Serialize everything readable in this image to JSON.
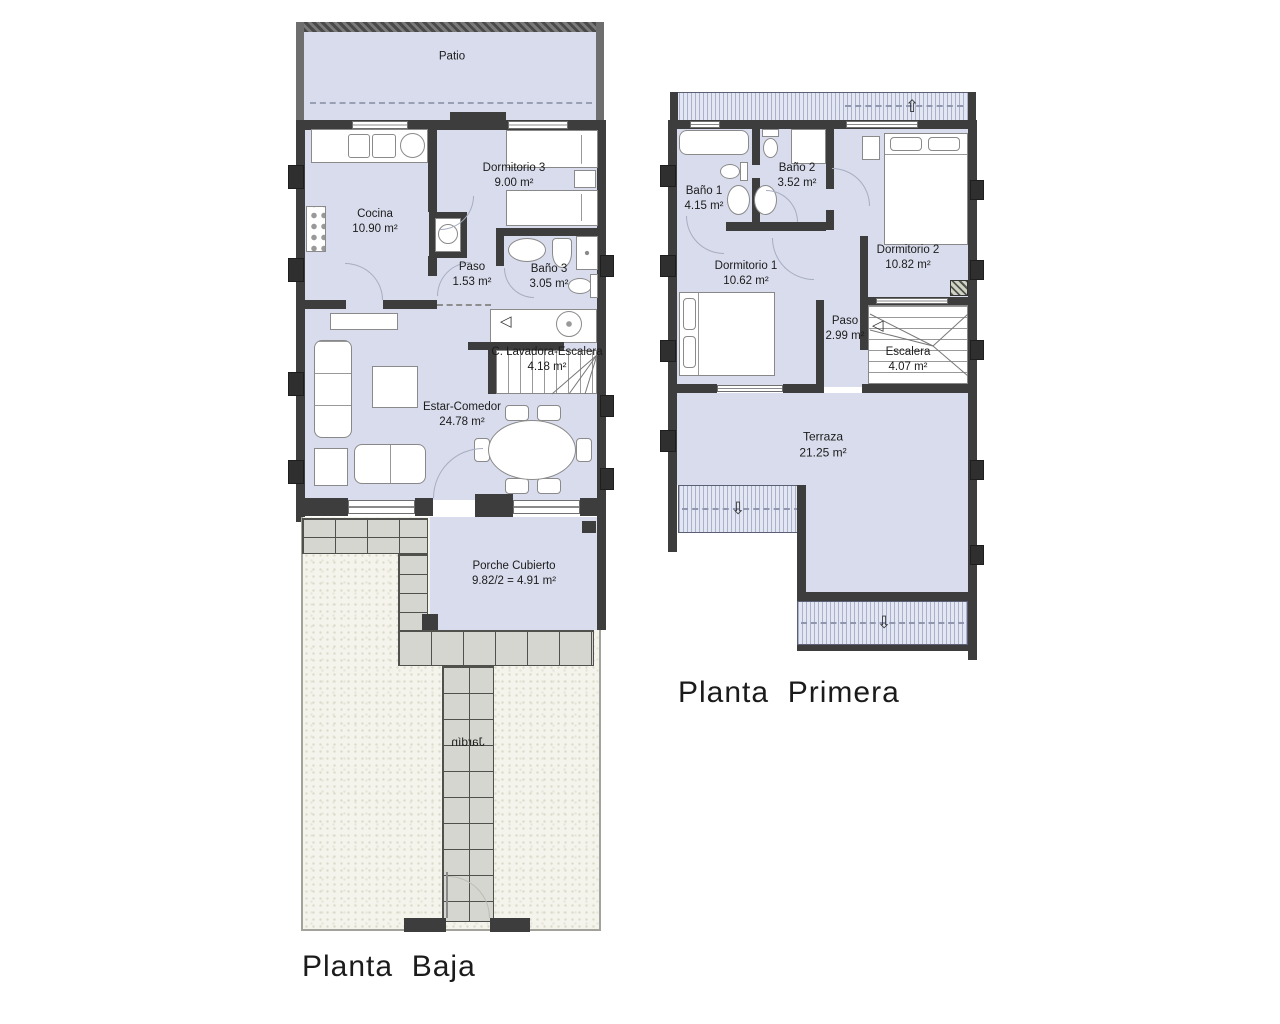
{
  "plans": {
    "ground": {
      "title": "Planta  Baja",
      "rooms": {
        "patio": {
          "name": "Patio"
        },
        "cocina": {
          "name": "Cocina",
          "area": "10.90 m²"
        },
        "dormitorio3": {
          "name": "Dormitorio 3",
          "area": "9.00 m²"
        },
        "paso": {
          "name": "Paso",
          "area": "1.53 m²"
        },
        "bano3": {
          "name": "Baño 3",
          "area": "3.05 m²"
        },
        "lavadora_escalera": {
          "name": "C. Lavadora-Escalera",
          "area": "4.18 m²"
        },
        "estar_comedor": {
          "name": "Estar-Comedor",
          "area": "24.78 m²"
        },
        "porche": {
          "name": "Porche Cubierto",
          "area": "9.82/2 = 4.91 m²"
        },
        "jardin": {
          "name": "Jardín"
        }
      }
    },
    "first": {
      "title": "Planta  Primera",
      "rooms": {
        "bano1": {
          "name": "Baño 1",
          "area": "4.15 m²"
        },
        "bano2": {
          "name": "Baño 2",
          "area": "3.52 m²"
        },
        "dormitorio1": {
          "name": "Dormitorio 1",
          "area": "10.62 m²"
        },
        "dormitorio2": {
          "name": "Dormitorio 2",
          "area": "10.82 m²"
        },
        "paso": {
          "name": "Paso",
          "area": "2.99 m²"
        },
        "escalera": {
          "name": "Escalera",
          "area": "4.07 m²"
        },
        "terraza": {
          "name": "Terraza",
          "area": "21.25 m²"
        }
      }
    }
  },
  "icons": {
    "roof_arrow_up": "⇧",
    "roof_arrow_down": "⇩",
    "stair_direction_arrow": "◁"
  },
  "colors": {
    "floor_fill": "#d9dcec",
    "wall": "#3d3d3d",
    "patio_wall": "#6e6e6e",
    "roof_hatch": "#e3e7f3",
    "tile": "#d6d6d0",
    "garden": "#f4f3ec",
    "background": "#ffffff",
    "label_text": "#1c1c1c"
  }
}
